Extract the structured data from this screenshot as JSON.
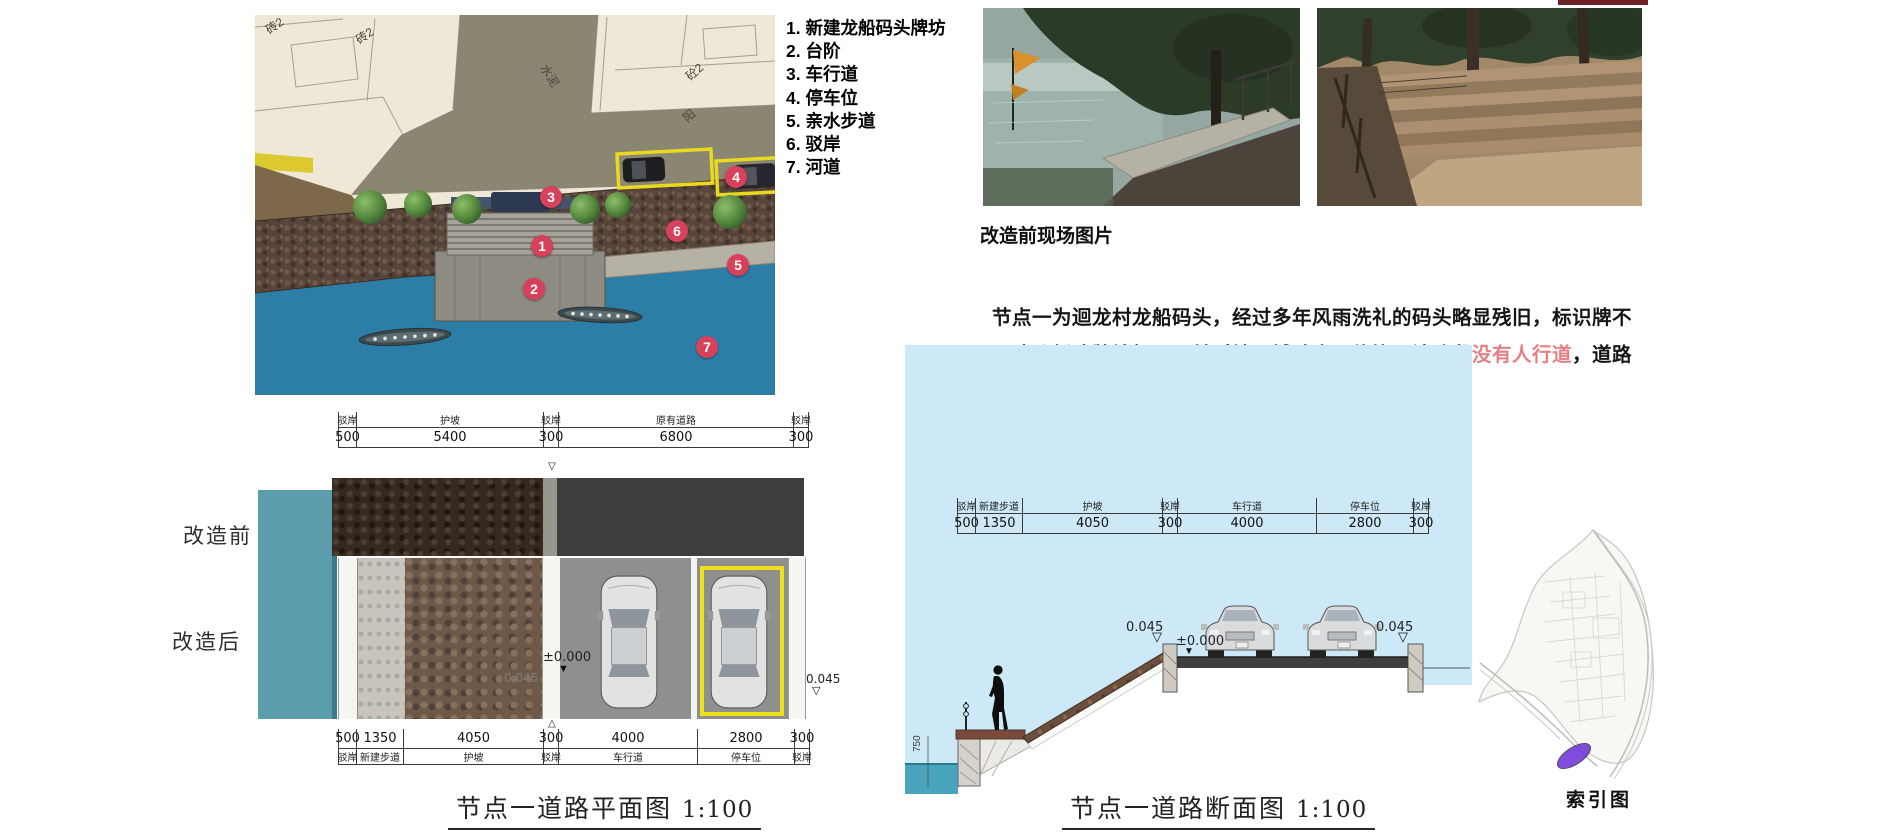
{
  "colors": {
    "accent_red": "#d7415c",
    "highlight_pink": "#e57f82",
    "water_blue": "#2d7ea6",
    "sky_blue": "#cde9f7",
    "teal": "#5b9dab",
    "parking_yellow": "#efe01c"
  },
  "symbols": {
    "down_open": "▽",
    "down_filled": "▼"
  },
  "legend": {
    "items": [
      "1. 新建龙船码头牌坊",
      "2. 台阶",
      "3. 车行道",
      "4. 停车位",
      "5. 亲水步道",
      "6. 驳岸",
      "7. 河道"
    ]
  },
  "site_plan": {
    "markers": [
      {
        "n": "1",
        "x": 287,
        "y": 231
      },
      {
        "n": "2",
        "x": 279,
        "y": 274
      },
      {
        "n": "3",
        "x": 296,
        "y": 182
      },
      {
        "n": "4",
        "x": 481,
        "y": 162
      },
      {
        "n": "5",
        "x": 483,
        "y": 250
      },
      {
        "n": "6",
        "x": 422,
        "y": 216
      },
      {
        "n": "7",
        "x": 452,
        "y": 332
      }
    ],
    "area_labels": [
      {
        "text": "砖2",
        "x": 10,
        "y": 2,
        "rot": -35
      },
      {
        "text": "砖2",
        "x": 100,
        "y": 12,
        "rot": -35
      },
      {
        "text": "水泥",
        "x": 283,
        "y": 52,
        "rot": 58
      },
      {
        "text": "砼2",
        "x": 430,
        "y": 48,
        "rot": -42
      },
      {
        "text": "阳",
        "x": 428,
        "y": 92,
        "rot": -42
      }
    ]
  },
  "photos": {
    "caption": "改造前现场图片"
  },
  "description": {
    "segments": [
      {
        "text": "　　节点一为迴龙村龙船码头，经过多年风雨洗礼的码头略显残旧，标识牌不\n明显。建议新建牌坊标示，并对地面铺贴麻石修饰。该路段",
        "highlight": false
      },
      {
        "text": "没有人行道",
        "highlight": true
      },
      {
        "text": "，道路\n宽约6.8米，建议改造车行道宽4米，停车位宽2.8米。",
        "highlight": false
      }
    ]
  },
  "plan_drawing": {
    "row_labels": [
      "改造前",
      "改造后"
    ],
    "dim_top": [
      {
        "label": "驳岸",
        "value": "500"
      },
      {
        "label": "护坡",
        "value": "5400"
      },
      {
        "label": "驳岸",
        "value": "300"
      },
      {
        "label": "原有道路",
        "value": "6800"
      },
      {
        "label": "驳岸",
        "value": "300"
      }
    ],
    "dim_bottom": [
      {
        "label": "驳岸",
        "value": "500"
      },
      {
        "label": "新建步道",
        "value": "1350"
      },
      {
        "label": "护坡",
        "value": "4050"
      },
      {
        "label": "驳岸",
        "value": "300"
      },
      {
        "label": "车行道",
        "value": "4000"
      },
      {
        "label": "停车位",
        "value": "2800"
      },
      {
        "label": "驳岸",
        "value": "300"
      }
    ],
    "levels": {
      "zero": "±0.000",
      "left": "0.045",
      "right": "0.045"
    },
    "caption": "节点一道路平面图",
    "scale": "1:100"
  },
  "section_drawing": {
    "dim": [
      {
        "label": "驳岸",
        "value": "500"
      },
      {
        "label": "新建步道",
        "value": "1350"
      },
      {
        "label": "护坡",
        "value": "4050"
      },
      {
        "label": "驳岸",
        "value": "300"
      },
      {
        "label": "车行道",
        "value": "4000"
      },
      {
        "label": "停车位",
        "value": "2800"
      },
      {
        "label": "驳岸",
        "value": "300"
      }
    ],
    "levels": {
      "left": "0.045",
      "zero": "±0.000",
      "right": "0.045",
      "wall": "750"
    },
    "caption": "节点一道路断面图",
    "scale": "1:100"
  },
  "index_map": {
    "caption": "索引图"
  }
}
